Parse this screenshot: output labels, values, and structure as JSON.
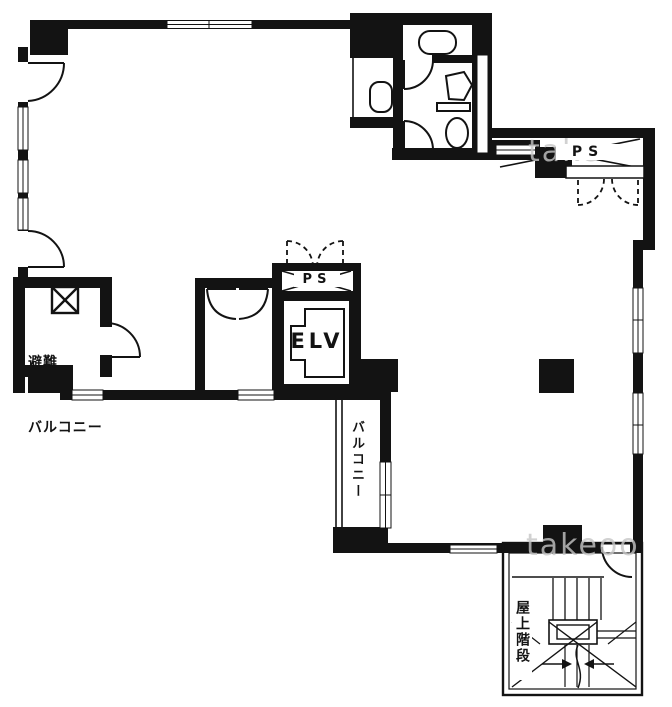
{
  "title": "building-floor-plan",
  "labels": {
    "evac_balcony_line1": "避難",
    "evac_balcony_line2": "バルコニー",
    "elevator": "ELV",
    "pipe_shaft_center": "PS",
    "pipe_shaft_top_right": "PS",
    "balcony_vertical": "バルコニー",
    "roof_stairs_vertical": "屋上階段"
  },
  "watermark": {
    "top": "take",
    "bottom": "takeoo"
  },
  "colors": {
    "wall": "#131313",
    "background": "#ffffff",
    "watermark": "#c6c6c6"
  },
  "icons": {
    "escape_hatch": "x-box-icon",
    "pipe_shaft": "cross-box-icon",
    "door": "quarter-arc-icon",
    "double_door": "double-arc-icon",
    "dashed_double_door": "dashed-double-arc-icon",
    "toilet": "toilet-icon",
    "sink": "sink-icon",
    "urinal": "urinal-icon",
    "elevator_car": "elevator-car-icon",
    "stairs": "stair-flight-icon",
    "column": "filled-square-icon"
  }
}
